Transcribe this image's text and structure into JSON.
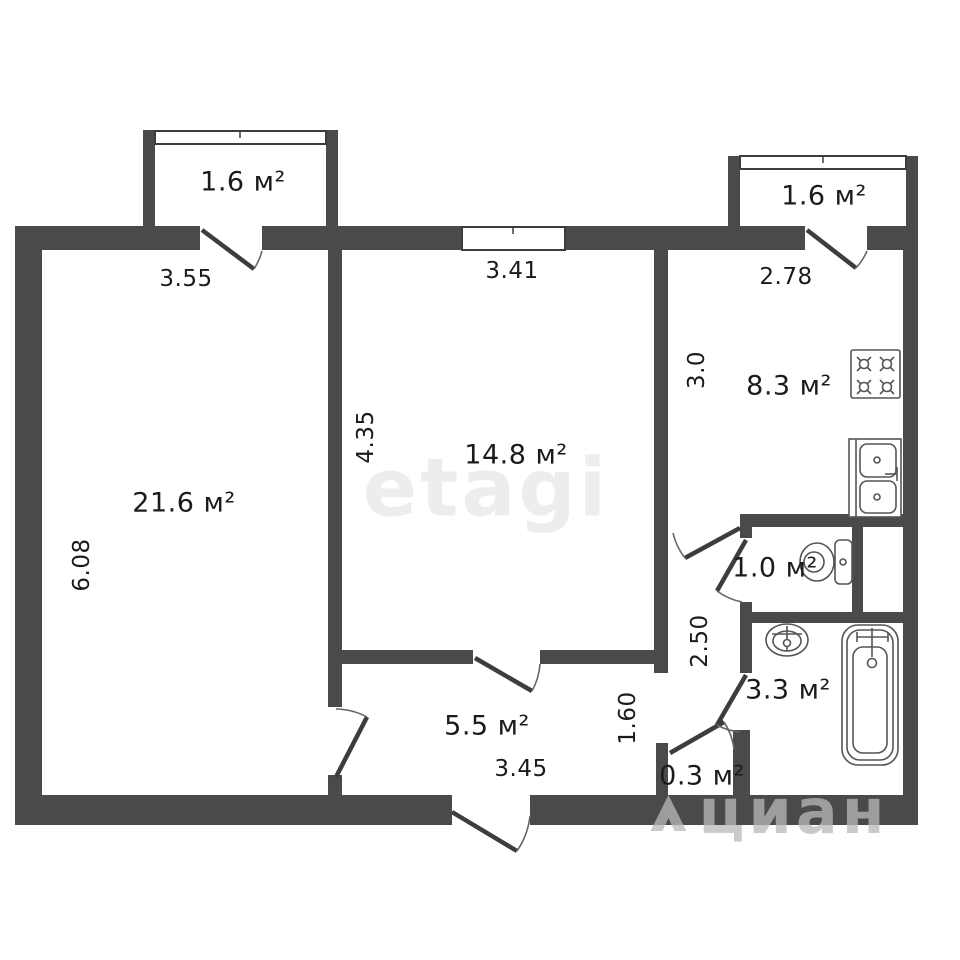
{
  "plan": {
    "rooms": [
      {
        "name": "living-room",
        "area": "21.6 м²",
        "width": "3.55",
        "height": "6.08"
      },
      {
        "name": "bedroom",
        "area": "14.8 м²",
        "width": "3.41",
        "height": "4.35"
      },
      {
        "name": "kitchen",
        "area": "8.3 м²",
        "width": "2.78",
        "height": "3.0"
      },
      {
        "name": "hallway",
        "area": "5.5 м²",
        "width": "3.45",
        "height": "1.60"
      },
      {
        "name": "corridor",
        "height": "2.50"
      },
      {
        "name": "wc",
        "area": "1.0 м²"
      },
      {
        "name": "bathroom",
        "area": "3.3 м²"
      },
      {
        "name": "closet",
        "area": "0.3 м²"
      },
      {
        "name": "balcony-left",
        "area": "1.6 м²"
      },
      {
        "name": "balcony-right",
        "area": "1.6 м²"
      }
    ],
    "watermarks": {
      "center": "etagi",
      "corner": "циан"
    }
  }
}
